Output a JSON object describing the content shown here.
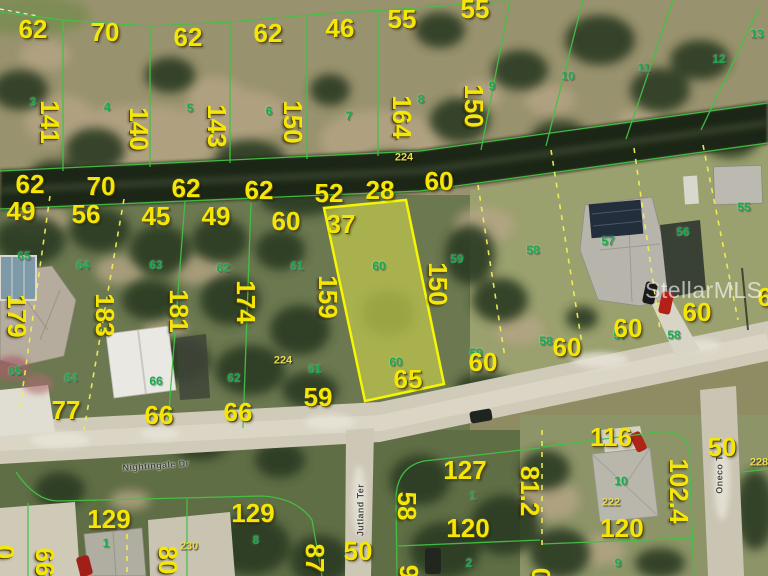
{
  "watermark": "StellarMLS",
  "colors": {
    "highlight_fill": "#e5e949",
    "highlight_border": "#f6f600",
    "parcel_line_green": "#44c144",
    "parcel_line_dashed_yellow": "#f2ee55",
    "dimension_text": "#f4e607",
    "lot_number_text": "#1ca94e",
    "water": "#1f2817",
    "road": "#d0cab9"
  },
  "streets": [
    "Nightingale Dr",
    "Jutland Ter",
    "Oneco Ter"
  ],
  "highlighted_parcel": {
    "frontage": "60",
    "depth_left": "159",
    "depth_right": "150",
    "rear": "65",
    "lot_number": "60"
  },
  "map_labels": [
    {
      "t": "62",
      "x": 33,
      "y": 29,
      "c": "y"
    },
    {
      "t": "70",
      "x": 105,
      "y": 32,
      "c": "y"
    },
    {
      "t": "62",
      "x": 188,
      "y": 37,
      "c": "y"
    },
    {
      "t": "62",
      "x": 268,
      "y": 33,
      "c": "y"
    },
    {
      "t": "46",
      "x": 340,
      "y": 28,
      "c": "y"
    },
    {
      "t": "55",
      "x": 402,
      "y": 19,
      "c": "y"
    },
    {
      "t": "55",
      "x": 475,
      "y": 9,
      "c": "y"
    },
    {
      "t": "141",
      "x": 50,
      "y": 122,
      "c": "y",
      "r": 90
    },
    {
      "t": "140",
      "x": 139,
      "y": 129,
      "c": "y",
      "r": 90
    },
    {
      "t": "143",
      "x": 217,
      "y": 126,
      "c": "y",
      "r": 90
    },
    {
      "t": "150",
      "x": 293,
      "y": 122,
      "c": "y",
      "r": 90
    },
    {
      "t": "164",
      "x": 402,
      "y": 117,
      "c": "y",
      "r": 90
    },
    {
      "t": "150",
      "x": 474,
      "y": 106,
      "c": "y",
      "r": 90
    },
    {
      "t": "3",
      "x": 33,
      "y": 102,
      "c": "g"
    },
    {
      "t": "4",
      "x": 107,
      "y": 107,
      "c": "g"
    },
    {
      "t": "5",
      "x": 190,
      "y": 108,
      "c": "g"
    },
    {
      "t": "6",
      "x": 269,
      "y": 111,
      "c": "g"
    },
    {
      "t": "7",
      "x": 349,
      "y": 116,
      "c": "g"
    },
    {
      "t": "8",
      "x": 421,
      "y": 99,
      "c": "g"
    },
    {
      "t": "9",
      "x": 492,
      "y": 86,
      "c": "g"
    },
    {
      "t": "10",
      "x": 568,
      "y": 76,
      "c": "g"
    },
    {
      "t": "11",
      "x": 644,
      "y": 68,
      "c": "g"
    },
    {
      "t": "12",
      "x": 719,
      "y": 59,
      "c": "g"
    },
    {
      "t": "13",
      "x": 757,
      "y": 34,
      "c": "g"
    },
    {
      "t": "224",
      "x": 404,
      "y": 158,
      "c": "p"
    },
    {
      "t": "62",
      "x": 30,
      "y": 184,
      "c": "y"
    },
    {
      "t": "70",
      "x": 101,
      "y": 186,
      "c": "y"
    },
    {
      "t": "62",
      "x": 186,
      "y": 188,
      "c": "y"
    },
    {
      "t": "62",
      "x": 259,
      "y": 190,
      "c": "y"
    },
    {
      "t": "52",
      "x": 329,
      "y": 193,
      "c": "y"
    },
    {
      "t": "28",
      "x": 380,
      "y": 190,
      "c": "y"
    },
    {
      "t": "60",
      "x": 439,
      "y": 181,
      "c": "y"
    },
    {
      "t": "49",
      "x": 21,
      "y": 211,
      "c": "y"
    },
    {
      "t": "56",
      "x": 86,
      "y": 214,
      "c": "y"
    },
    {
      "t": "45",
      "x": 156,
      "y": 216,
      "c": "y"
    },
    {
      "t": "49",
      "x": 216,
      "y": 216,
      "c": "y"
    },
    {
      "t": "60",
      "x": 286,
      "y": 221,
      "c": "y"
    },
    {
      "t": "37",
      "x": 341,
      "y": 224,
      "c": "y"
    },
    {
      "t": "65",
      "x": 24,
      "y": 256,
      "c": "g"
    },
    {
      "t": "64",
      "x": 83,
      "y": 265,
      "c": "g"
    },
    {
      "t": "63",
      "x": 156,
      "y": 265,
      "c": "g"
    },
    {
      "t": "62",
      "x": 223,
      "y": 268,
      "c": "g"
    },
    {
      "t": "61",
      "x": 297,
      "y": 266,
      "c": "g"
    },
    {
      "t": "60",
      "x": 379,
      "y": 266,
      "c": "g"
    },
    {
      "t": "59",
      "x": 457,
      "y": 259,
      "c": "g"
    },
    {
      "t": "58",
      "x": 533,
      "y": 250,
      "c": "g"
    },
    {
      "t": "57",
      "x": 608,
      "y": 241,
      "c": "g"
    },
    {
      "t": "56",
      "x": 683,
      "y": 232,
      "c": "g"
    },
    {
      "t": "55",
      "x": 744,
      "y": 207,
      "c": "g"
    },
    {
      "t": "179",
      "x": 17,
      "y": 316,
      "c": "y",
      "r": 90
    },
    {
      "t": "183",
      "x": 105,
      "y": 315,
      "c": "y",
      "r": 90
    },
    {
      "t": "181",
      "x": 179,
      "y": 311,
      "c": "y",
      "r": 90
    },
    {
      "t": "174",
      "x": 246,
      "y": 302,
      "c": "y",
      "r": 90
    },
    {
      "t": "159",
      "x": 328,
      "y": 297,
      "c": "y",
      "r": 90
    },
    {
      "t": "150",
      "x": 438,
      "y": 284,
      "c": "y",
      "r": 90
    },
    {
      "t": "65",
      "x": 15,
      "y": 371,
      "c": "g"
    },
    {
      "t": "64",
      "x": 71,
      "y": 378,
      "c": "g"
    },
    {
      "t": "66",
      "x": 156,
      "y": 381,
      "c": "g"
    },
    {
      "t": "62",
      "x": 234,
      "y": 378,
      "c": "g"
    },
    {
      "t": "61",
      "x": 315,
      "y": 369,
      "c": "g"
    },
    {
      "t": "60",
      "x": 396,
      "y": 362,
      "c": "g"
    },
    {
      "t": "59",
      "x": 476,
      "y": 353,
      "c": "g"
    },
    {
      "t": "58",
      "x": 546,
      "y": 341,
      "c": "g"
    },
    {
      "t": "57",
      "x": 620,
      "y": 335,
      "c": "g"
    },
    {
      "t": "58",
      "x": 674,
      "y": 335,
      "c": "g"
    },
    {
      "t": "224",
      "x": 283,
      "y": 361,
      "c": "p"
    },
    {
      "t": "59",
      "x": 318,
      "y": 397,
      "c": "y"
    },
    {
      "t": "65",
      "x": 408,
      "y": 379,
      "c": "y"
    },
    {
      "t": "60",
      "x": 483,
      "y": 362,
      "c": "y"
    },
    {
      "t": "60",
      "x": 567,
      "y": 347,
      "c": "y"
    },
    {
      "t": "60",
      "x": 628,
      "y": 328,
      "c": "y"
    },
    {
      "t": "60",
      "x": 772,
      "y": 297,
      "c": "y"
    },
    {
      "t": "60",
      "x": 697,
      "y": 312,
      "c": "y"
    },
    {
      "t": "77",
      "x": 66,
      "y": 410,
      "c": "y"
    },
    {
      "t": "66",
      "x": 159,
      "y": 415,
      "c": "y"
    },
    {
      "t": "66",
      "x": 238,
      "y": 412,
      "c": "y"
    },
    {
      "t": "Nightingale Dr",
      "x": 156,
      "y": 466,
      "c": "st",
      "r": -4
    },
    {
      "t": "Jutland Ter",
      "x": 361,
      "y": 510,
      "c": "st",
      "r": -90
    },
    {
      "t": "Oneco Ter",
      "x": 720,
      "y": 470,
      "c": "st",
      "r": -90
    },
    {
      "t": "129",
      "x": 109,
      "y": 519,
      "c": "y"
    },
    {
      "t": "129",
      "x": 253,
      "y": 513,
      "c": "y"
    },
    {
      "t": "1",
      "x": 106,
      "y": 543,
      "c": "g"
    },
    {
      "t": "8",
      "x": 256,
      "y": 540,
      "c": "g"
    },
    {
      "t": "230",
      "x": 189,
      "y": 547,
      "c": "p"
    },
    {
      "t": "0",
      "x": 5,
      "y": 552,
      "c": "y",
      "r": 90
    },
    {
      "t": "66",
      "x": 45,
      "y": 562,
      "c": "y",
      "r": 90
    },
    {
      "t": "80",
      "x": 168,
      "y": 560,
      "c": "y",
      "r": 90
    },
    {
      "t": "87",
      "x": 315,
      "y": 558,
      "c": "y",
      "r": 90
    },
    {
      "t": "50",
      "x": 358,
      "y": 551,
      "c": "y"
    },
    {
      "t": "9",
      "x": 409,
      "y": 572,
      "c": "y",
      "r": 90
    },
    {
      "t": "58",
      "x": 407,
      "y": 506,
      "c": "y",
      "r": 90
    },
    {
      "t": "127",
      "x": 465,
      "y": 470,
      "c": "y"
    },
    {
      "t": "120",
      "x": 468,
      "y": 528,
      "c": "y"
    },
    {
      "t": "1",
      "x": 473,
      "y": 496,
      "c": "g"
    },
    {
      "t": "2",
      "x": 469,
      "y": 563,
      "c": "g"
    },
    {
      "t": "0",
      "x": 541,
      "y": 575,
      "c": "y",
      "r": 90
    },
    {
      "t": "116",
      "x": 611,
      "y": 437,
      "c": "y"
    },
    {
      "t": "81.2",
      "x": 530,
      "y": 491,
      "c": "y",
      "r": 90
    },
    {
      "t": "102.4",
      "x": 679,
      "y": 491,
      "c": "y",
      "r": 90
    },
    {
      "t": "120",
      "x": 622,
      "y": 528,
      "c": "y"
    },
    {
      "t": "10",
      "x": 621,
      "y": 481,
      "c": "g"
    },
    {
      "t": "9",
      "x": 618,
      "y": 563,
      "c": "g"
    },
    {
      "t": "222",
      "x": 611,
      "y": 503,
      "c": "p"
    },
    {
      "t": "228",
      "x": 759,
      "y": 463,
      "c": "p"
    },
    {
      "t": "50",
      "x": 722,
      "y": 447,
      "c": "y"
    }
  ]
}
